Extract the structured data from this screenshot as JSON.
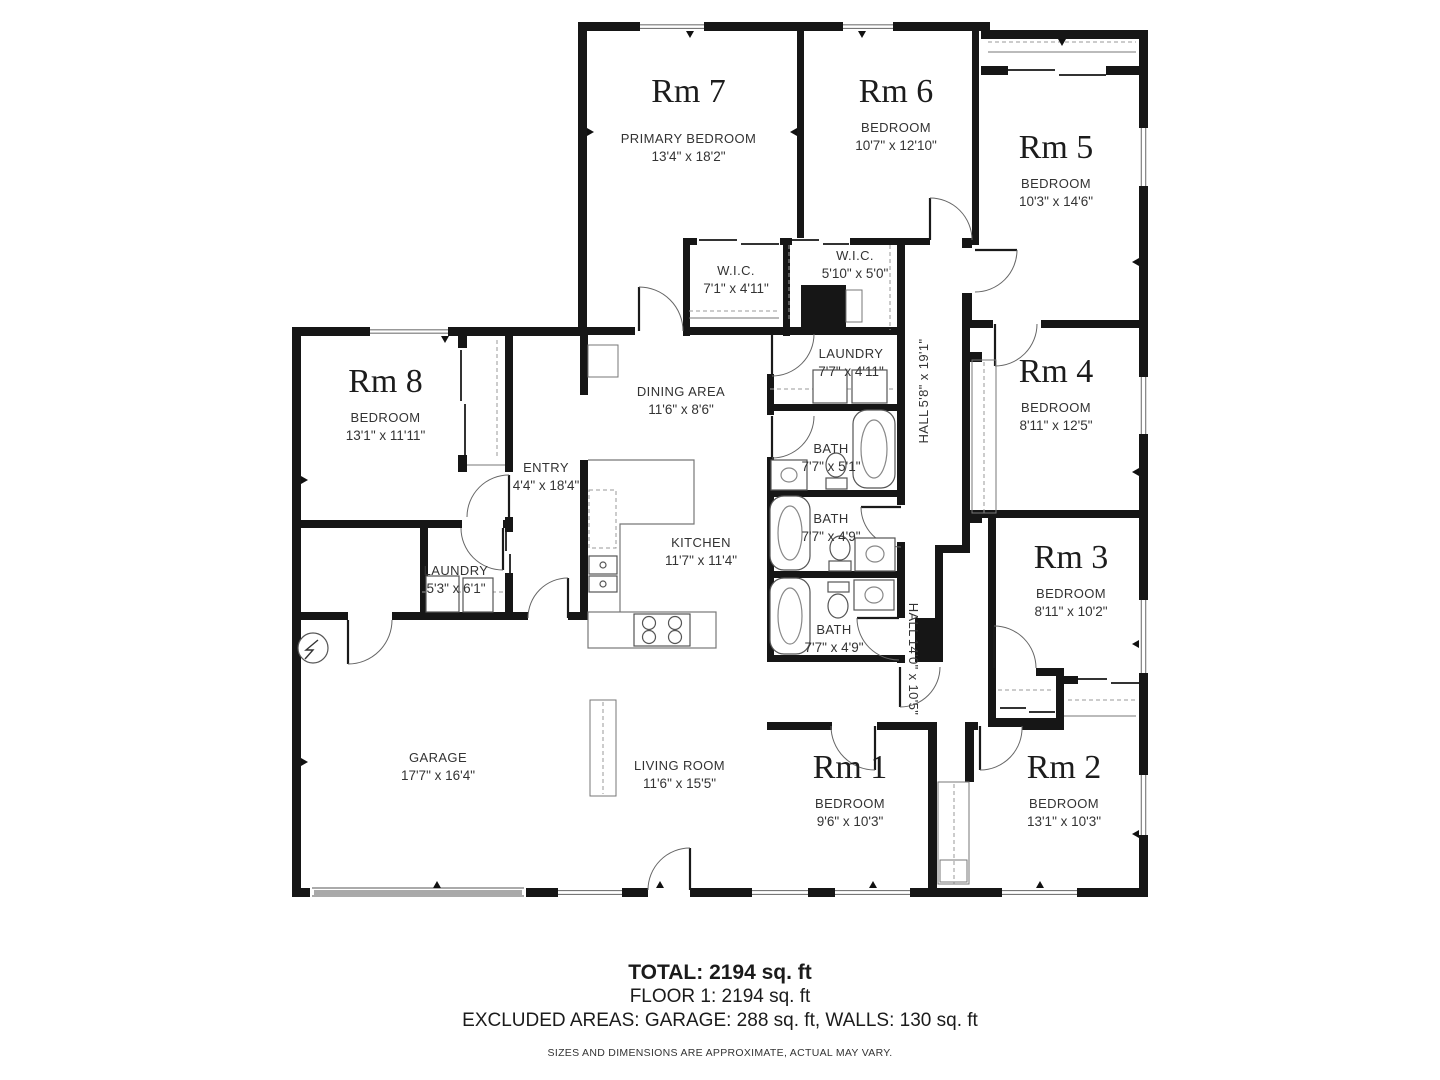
{
  "rooms": {
    "rm7": {
      "title": "Rm 7",
      "type": "PRIMARY BEDROOM",
      "dims": "13'4\" x 18'2\""
    },
    "rm6": {
      "title": "Rm 6",
      "type": "BEDROOM",
      "dims": "10'7\" x 12'10\""
    },
    "rm5": {
      "title": "Rm 5",
      "type": "BEDROOM",
      "dims": "10'3\" x 14'6\""
    },
    "rm4": {
      "title": "Rm 4",
      "type": "BEDROOM",
      "dims": "8'11\" x 12'5\""
    },
    "rm3": {
      "title": "Rm 3",
      "type": "BEDROOM",
      "dims": "8'11\" x 10'2\""
    },
    "rm2": {
      "title": "Rm 2",
      "type": "BEDROOM",
      "dims": "13'1\" x 10'3\""
    },
    "rm1": {
      "title": "Rm 1",
      "type": "BEDROOM",
      "dims": "9'6\" x 10'3\""
    },
    "rm8": {
      "title": "Rm 8",
      "type": "BEDROOM",
      "dims": "13'1\" x 11'11\""
    },
    "wic1": {
      "type": "W.I.C.",
      "dims": "7'1\" x 4'11\""
    },
    "wic2": {
      "type": "W.I.C.",
      "dims": "5'10\" x 5'0\""
    },
    "laundry_main": {
      "type": "LAUNDRY",
      "dims": "7'7\" x 4'11\""
    },
    "hall_main": {
      "type": "HALL",
      "dims": "5'8\" x 19'1\""
    },
    "bath1": {
      "type": "BATH",
      "dims": "7'7\" x 5'1\""
    },
    "bath2": {
      "type": "BATH",
      "dims": "7'7\" x 4'9\""
    },
    "bath3": {
      "type": "BATH",
      "dims": "7'7\" x 4'9\""
    },
    "dining": {
      "type": "DINING AREA",
      "dims": "11'6\" x 8'6\""
    },
    "entry": {
      "type": "ENTRY",
      "dims": "4'4\" x 18'4\""
    },
    "kitchen": {
      "type": "KITCHEN",
      "dims": "11'7\" x 11'4\""
    },
    "laundry_garage": {
      "type": "LAUNDRY",
      "dims": "5'3\" x 6'1\""
    },
    "garage": {
      "type": "GARAGE",
      "dims": "17'7\" x 16'4\""
    },
    "living": {
      "type": "LIVING ROOM",
      "dims": "11'6\" x 15'5\""
    },
    "hall_back": {
      "type": "HALL",
      "dims": "14'0\" x 10'5\""
    }
  },
  "footer": {
    "total": "TOTAL: 2194 sq. ft",
    "floor": "FLOOR 1: 2194 sq. ft",
    "excluded": "EXCLUDED AREAS: GARAGE: 288 sq. ft, WALLS: 130 sq. ft",
    "disclaimer": "SIZES AND DIMENSIONS ARE APPROXIMATE, ACTUAL MAY VARY."
  },
  "colors": {
    "walls": "#161616",
    "fixture_lines": "#555555",
    "text": "#2a2a2a"
  }
}
